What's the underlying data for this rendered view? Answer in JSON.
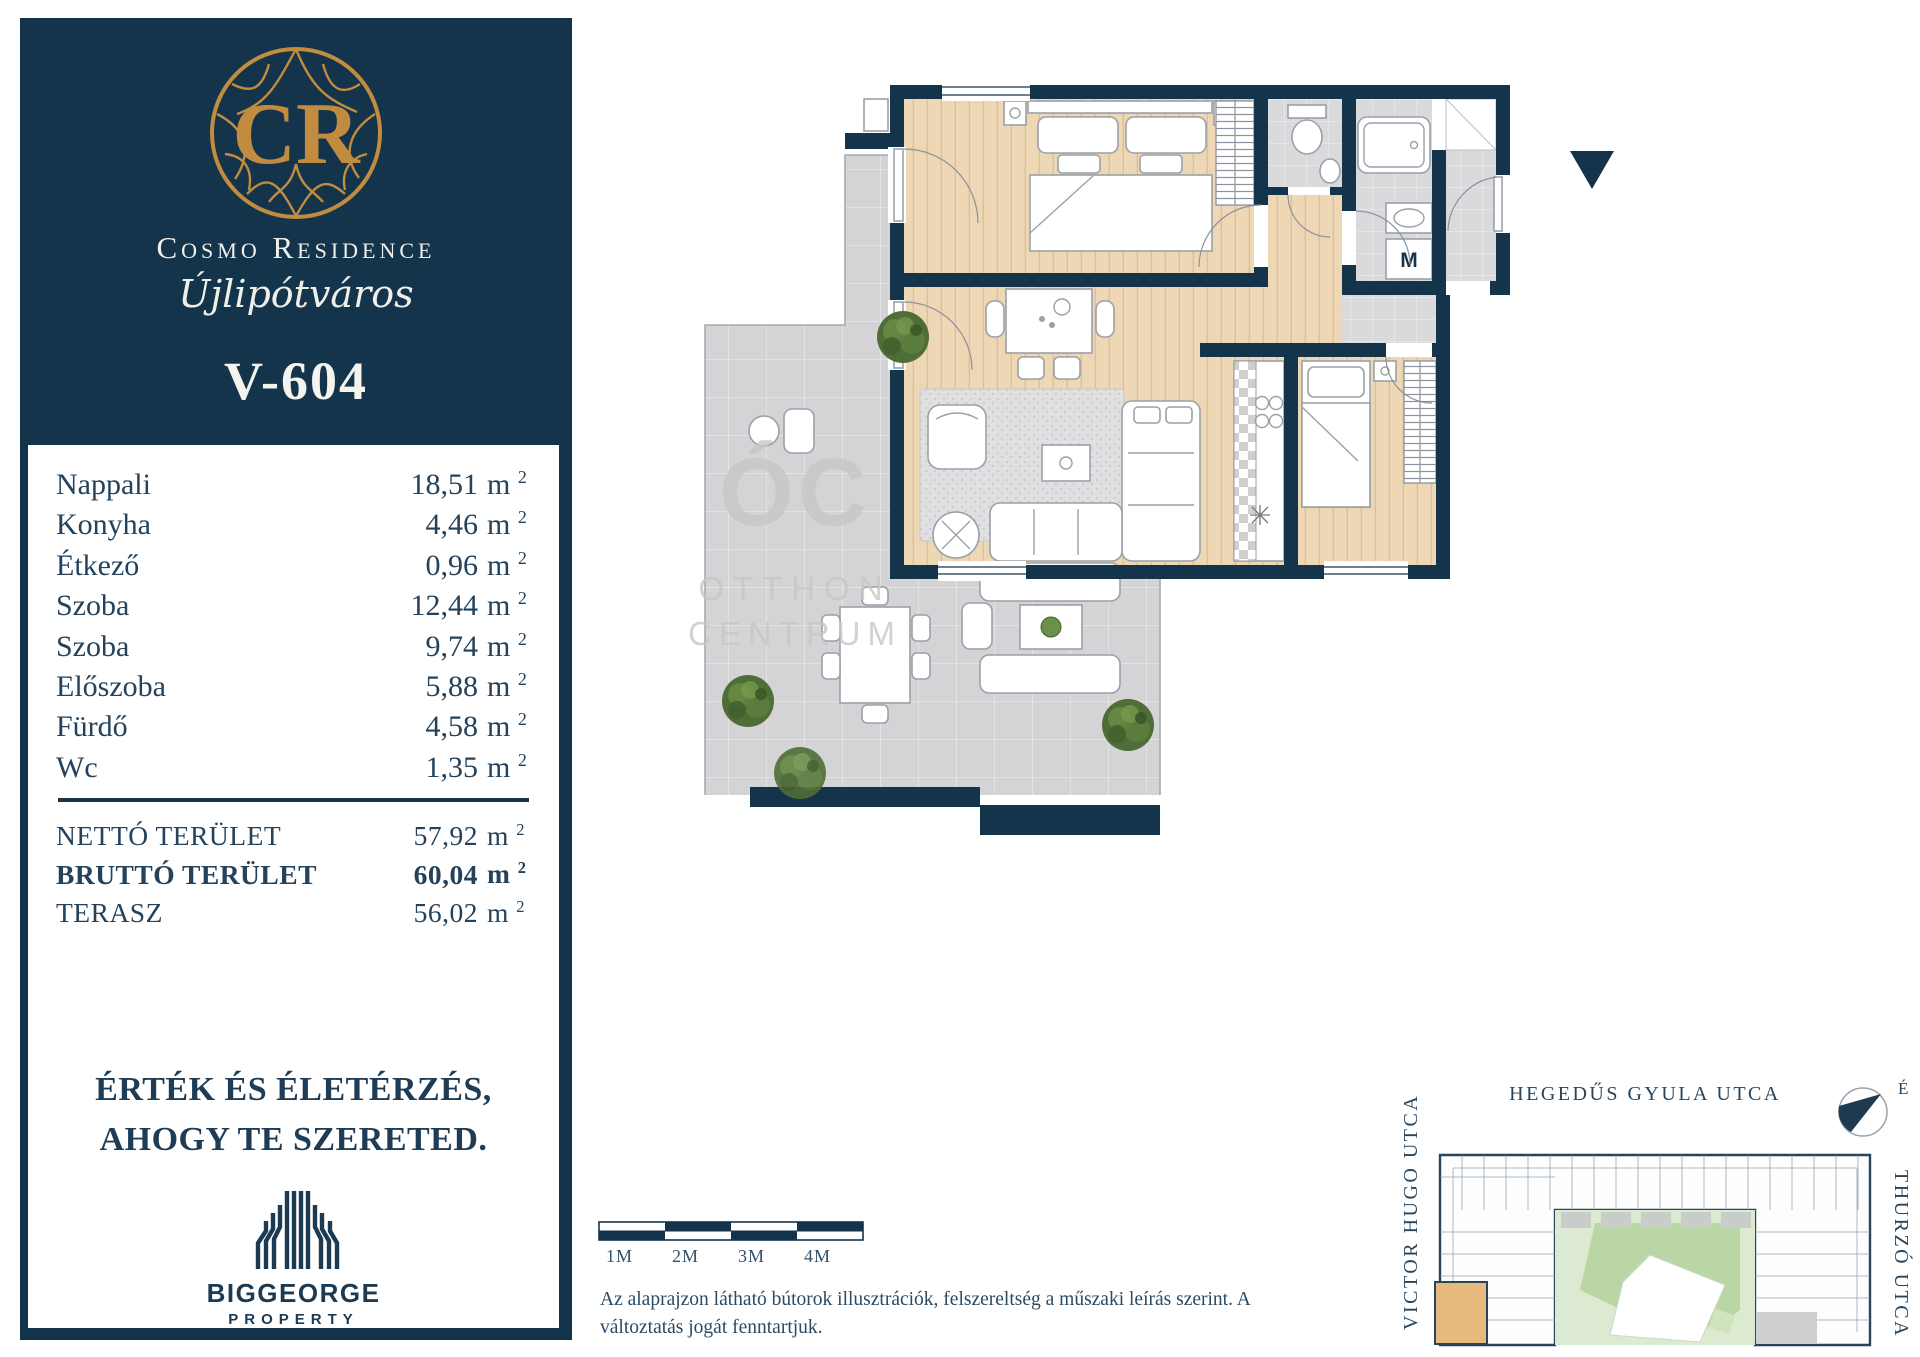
{
  "colors": {
    "navy": "#14344c",
    "gold": "#c18c3f",
    "wood": "#eed7b5",
    "terrace_gray": "#d4d4d6",
    "courtyard_green": "#b9d6a4",
    "highlight_orange": "#e8b97c"
  },
  "sidebar": {
    "brand": {
      "monogram": "CR",
      "name": "Cosmo Residence",
      "subtitle": "Újlipótváros"
    },
    "unit_id": "V-604",
    "unit": "m",
    "unit_sup": "2",
    "rooms": [
      {
        "name": "Nappali",
        "area": "18,51"
      },
      {
        "name": "Konyha",
        "area": "4,46"
      },
      {
        "name": "Étkező",
        "area": "0,96"
      },
      {
        "name": "Szoba",
        "area": "12,44"
      },
      {
        "name": "Szoba",
        "area": "9,74"
      },
      {
        "name": "Előszoba",
        "area": "5,88"
      },
      {
        "name": "Fürdő",
        "area": "4,58"
      },
      {
        "name": "Wc",
        "area": "1,35"
      }
    ],
    "totals": [
      {
        "label": "NETTÓ TERÜLET",
        "value": "57,92"
      },
      {
        "label": "BRUTTÓ TERÜLET",
        "value": "60,04"
      },
      {
        "label": "TERASZ",
        "value": "56,02"
      }
    ],
    "tagline_line1": "ÉRTÉK ÉS ÉLETÉRZÉS,",
    "tagline_line2": "AHOGY TE SZERETED.",
    "developer": {
      "name": "BIGGEORGE",
      "division": "PROPERTY"
    }
  },
  "floorplan": {
    "machine_label": "M",
    "watermark": [
      "ÓC",
      "OTTHON",
      "CENTRUM"
    ]
  },
  "scalebar": {
    "labels": [
      "1M",
      "2M",
      "3M",
      "4M"
    ]
  },
  "disclaimer": {
    "line1": "Az alaprajzon látható bútorok illusztrációk, felszereltség a műszaki leírás szerint.  A",
    "line2": "változtatás jogát fenntartjuk."
  },
  "siteplan": {
    "street_top": "HEGEDŰS GYULA UTCA",
    "street_left": "VICTOR HUGO UTCA",
    "street_right": "THURZÓ UTCA",
    "compass_label": "É"
  }
}
